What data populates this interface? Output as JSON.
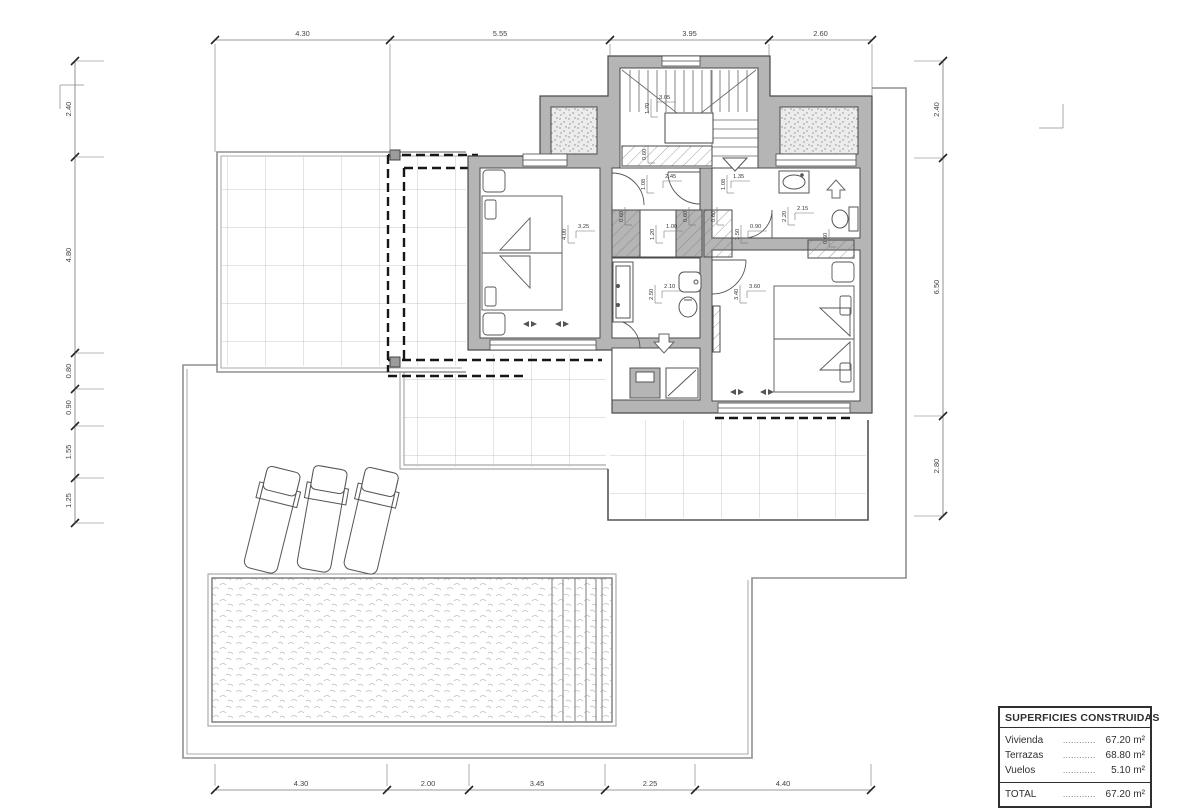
{
  "areas_table": {
    "title": "SUPERFICIES CONSTRUIDAS",
    "rows": [
      {
        "label": "Vivienda",
        "leader": "............",
        "value": "67.20 m²"
      },
      {
        "label": "Terrazas",
        "leader": "............",
        "value": "68.80 m²"
      },
      {
        "label": "Vuelos",
        "leader": "............",
        "value": "5.10 m²"
      }
    ],
    "total": {
      "label": "TOTAL",
      "leader": "............",
      "value": "67.20 m²"
    }
  },
  "perimeter_dimensions": {
    "top": [
      "4.30",
      "5.55",
      "3.95",
      "2.60"
    ],
    "bottom": [
      "4.30",
      "2.00",
      "3.45",
      "2.25",
      "4.40"
    ],
    "left": [
      "2.40",
      "4.80",
      "0.80",
      "0.90",
      "1.55",
      "1.25"
    ],
    "right": [
      "2.40",
      "6.50",
      "2.80"
    ]
  },
  "interior_dimensions": [
    {
      "t": "3.05",
      "x": 659,
      "y": 99,
      "o": "h"
    },
    {
      "t": "1.70",
      "x": 649,
      "y": 114,
      "o": "v"
    },
    {
      "t": "2.45",
      "x": 665,
      "y": 178,
      "o": "h"
    },
    {
      "t": "1.08",
      "x": 645,
      "y": 190,
      "o": "v"
    },
    {
      "t": "1.35",
      "x": 733,
      "y": 178,
      "o": "h"
    },
    {
      "t": "1.08",
      "x": 725,
      "y": 190,
      "o": "v"
    },
    {
      "t": "3.25",
      "x": 578,
      "y": 228,
      "o": "h"
    },
    {
      "t": "4.00",
      "x": 566,
      "y": 240,
      "o": "v"
    },
    {
      "t": "1.00",
      "x": 666,
      "y": 228,
      "o": "h"
    },
    {
      "t": "1.20",
      "x": 654,
      "y": 240,
      "o": "v"
    },
    {
      "t": "0.90",
      "x": 750,
      "y": 228,
      "o": "h"
    },
    {
      "t": "1.50",
      "x": 739,
      "y": 240,
      "o": "v"
    },
    {
      "t": "2.10",
      "x": 664,
      "y": 288,
      "o": "h"
    },
    {
      "t": "2.50",
      "x": 653,
      "y": 300,
      "o": "v"
    },
    {
      "t": "3.60",
      "x": 749,
      "y": 288,
      "o": "h"
    },
    {
      "t": "3.40",
      "x": 738,
      "y": 300,
      "o": "v"
    },
    {
      "t": "2.15",
      "x": 797,
      "y": 210,
      "o": "h"
    },
    {
      "t": "2.20",
      "x": 786,
      "y": 222,
      "o": "v"
    },
    {
      "t": "0.60",
      "x": 623,
      "y": 222,
      "o": "v"
    },
    {
      "t": "0.60",
      "x": 687,
      "y": 222,
      "o": "v"
    },
    {
      "t": "0.60",
      "x": 715,
      "y": 222,
      "o": "v"
    },
    {
      "t": "0.60",
      "x": 827,
      "y": 244,
      "o": "v"
    },
    {
      "t": "0.60",
      "x": 646,
      "y": 160,
      "o": "v"
    }
  ],
  "symbols": {
    "entry_arrow": "down-arrow",
    "stair_direction": "down-triangle",
    "shaft_arrow": "up-arrow",
    "window_swing": "paired-triangles"
  },
  "colors": {
    "wall_fill": "#b5b5b5",
    "wall_line": "#4a4a4a",
    "dashed_overhang": "#161616",
    "dimension_text": "#444444",
    "tile_grid": "#c9c9c9",
    "boundary": "#909090",
    "pool_texture": "#bfbfbf"
  }
}
